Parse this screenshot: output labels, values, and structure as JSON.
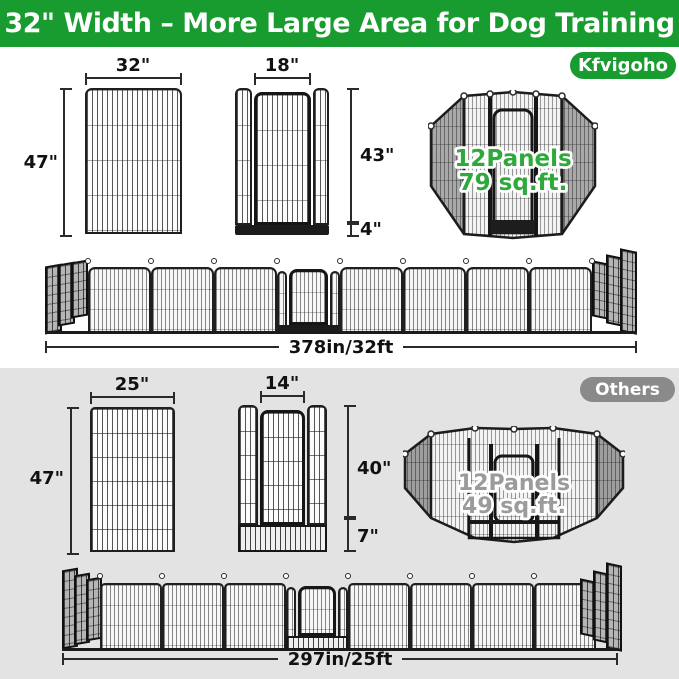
{
  "header": {
    "title": "32\" Width – More Large Area for Dog Training"
  },
  "brand_section": {
    "badge": "Kfvigoho",
    "panel": {
      "width": "32\"",
      "height": "47\""
    },
    "gate": {
      "width": "18\"",
      "door_height": "43\"",
      "base_height": "4\""
    },
    "pen": {
      "panels": "12Panels",
      "area": "79 sq.ft."
    },
    "row": {
      "length": "378in/32ft"
    }
  },
  "others_section": {
    "badge": "Others",
    "panel": {
      "width": "25\"",
      "height": "47\""
    },
    "gate": {
      "width": "14\"",
      "door_height": "40\"",
      "base_height": "7\""
    },
    "pen": {
      "panels": "12Panels",
      "area": "49 sq.ft."
    },
    "row": {
      "length": "297in/25ft"
    }
  },
  "colors": {
    "brand_green": "#189b2f",
    "others_gray": "#8a8a8a",
    "bottom_section_bg": "#e3e3e3",
    "overlay_green_text": "#2fa83c",
    "overlay_gray_text": "#9b9b9b",
    "wire_dark": "#1f1f1f"
  }
}
